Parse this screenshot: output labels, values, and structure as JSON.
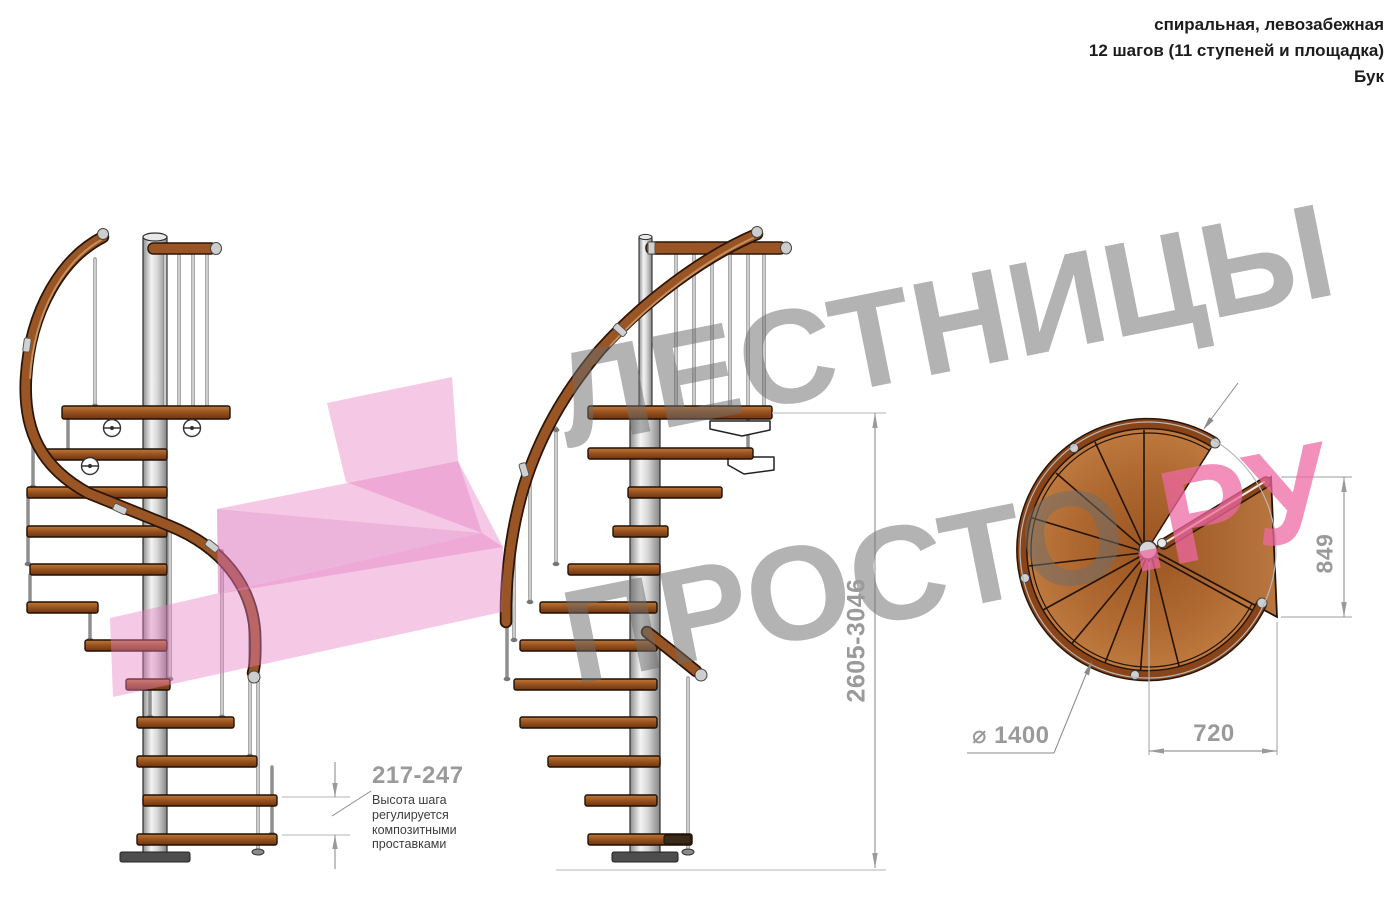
{
  "header": {
    "type_line": "спиральная, левозабежная",
    "steps_line": "12 шагов (11 ступеней и площадка)",
    "material_line": "Бук"
  },
  "watermark": {
    "line1": "ЛЕСТНИЦЫ",
    "line2_gray": "ПРОСТО",
    "line2_pink": ".РУ"
  },
  "dimensions": {
    "step_height_range": "217-247",
    "total_height_range": "2605-3046",
    "landing_side": "849",
    "landing_depth": "720",
    "diameter": "⌀ 1400"
  },
  "notes": {
    "step_height_note": "Высота шага\nрегулируется\nкомпозитными\nпроставками"
  },
  "colors": {
    "wood": "#a05a24",
    "handrail": "#9a5524",
    "metal": "#d9d9d9",
    "dimension_gray": "#9a9a9a",
    "watermark_gray": "#9b9b9b",
    "watermark_pink": "#ee68a2",
    "arrow_pink": "#e87fc4"
  }
}
